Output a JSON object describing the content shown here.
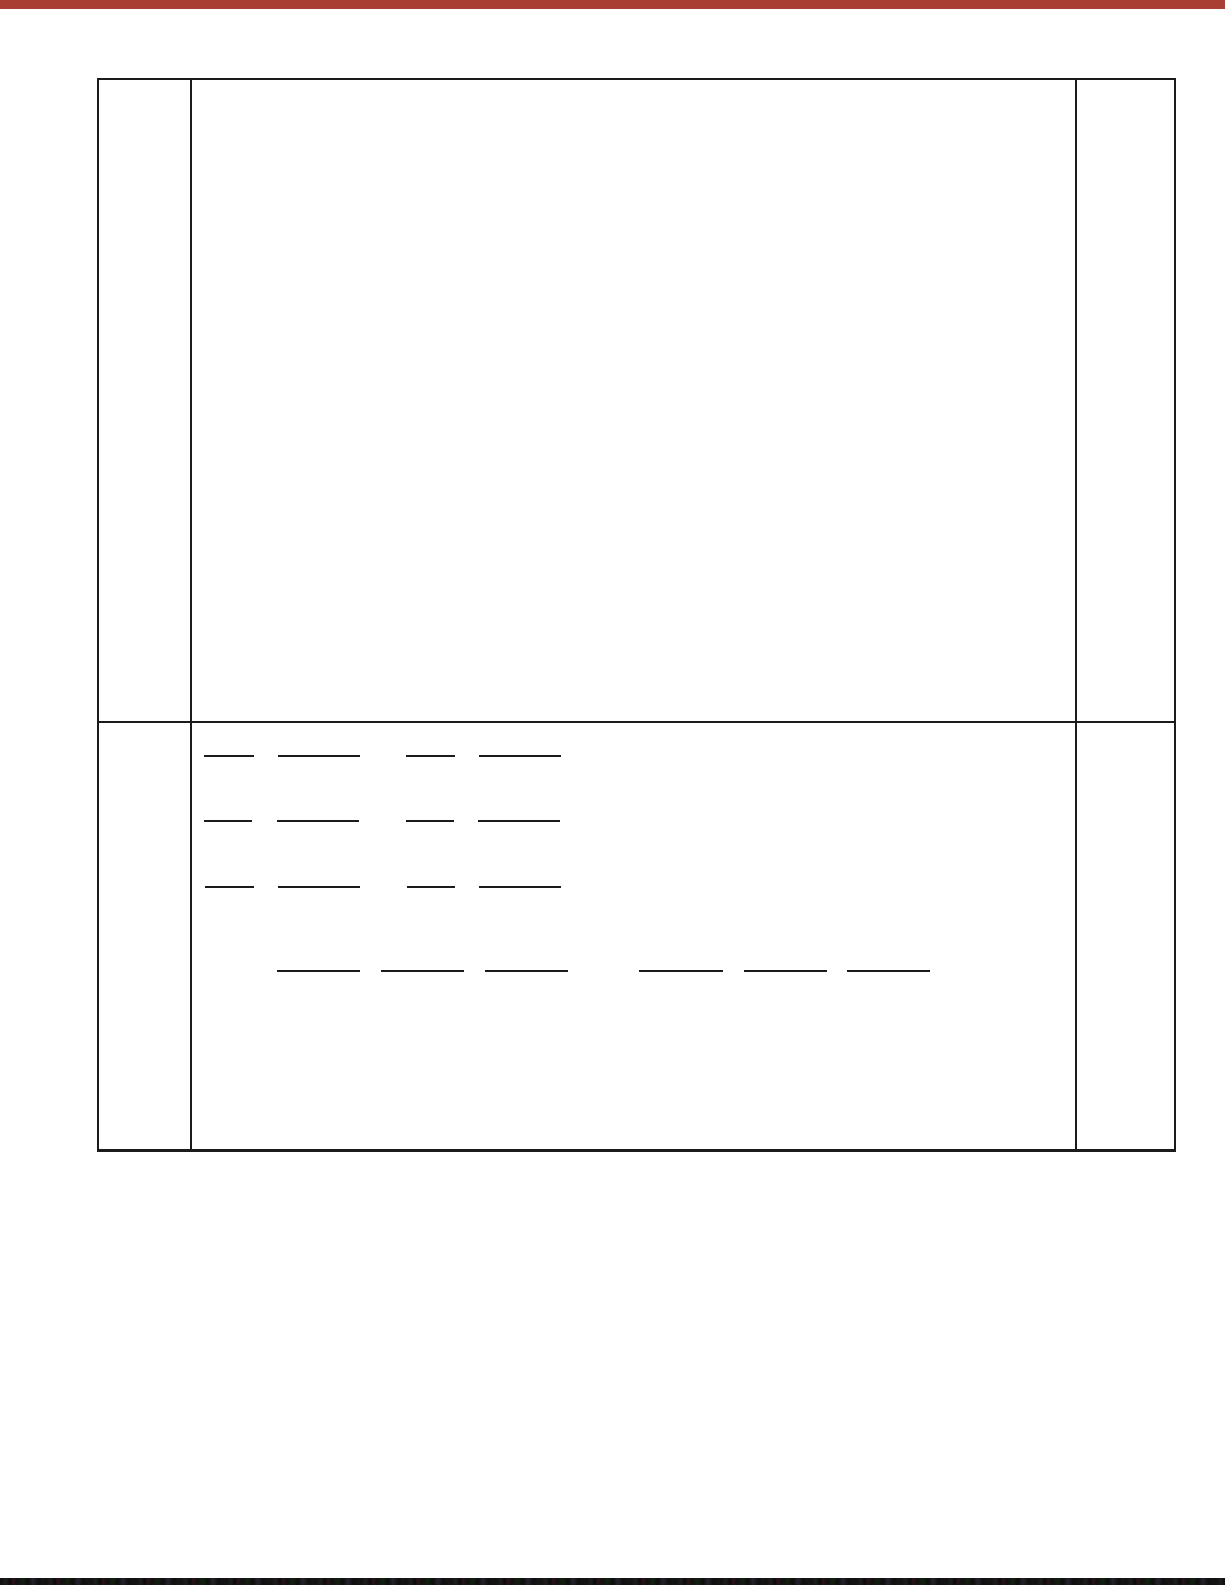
{
  "page": {
    "kind": "scanned-worksheet-page",
    "background": "#ffffff"
  },
  "scan_artifacts": {
    "top_bar": {
      "color": "#a93e32",
      "height_px": 9
    },
    "bottom_bar": {
      "color": "#141414",
      "height_px": 7
    }
  },
  "table": {
    "border_color": "#1b1b1b",
    "columns": 3,
    "rows": 2,
    "cells": {
      "row1_left": "",
      "row1_middle": "",
      "row1_right": "",
      "row2_left": "",
      "row2_middle": "",
      "row2_right": ""
    }
  },
  "answer_blanks": {
    "line_color": "#1b1b1b",
    "line_thickness_px": 2,
    "rows": [
      {
        "y": 32,
        "segments": [
          {
            "x": 12,
            "w": 50
          },
          {
            "x": 86,
            "w": 82
          },
          {
            "x": 214,
            "w": 49
          },
          {
            "x": 287,
            "w": 82
          }
        ]
      },
      {
        "y": 97,
        "segments": [
          {
            "x": 12,
            "w": 48
          },
          {
            "x": 85,
            "w": 82
          },
          {
            "x": 214,
            "w": 48
          },
          {
            "x": 286,
            "w": 82
          }
        ]
      },
      {
        "y": 163,
        "segments": [
          {
            "x": 13,
            "w": 49
          },
          {
            "x": 86,
            "w": 82
          },
          {
            "x": 215,
            "w": 48
          },
          {
            "x": 287,
            "w": 82
          }
        ]
      },
      {
        "y": 247,
        "segments": [
          {
            "x": 85,
            "w": 83
          },
          {
            "x": 189,
            "w": 83
          },
          {
            "x": 293,
            "w": 83
          },
          {
            "x": 447,
            "w": 84
          },
          {
            "x": 552,
            "w": 83
          },
          {
            "x": 655,
            "w": 83
          }
        ]
      }
    ]
  }
}
